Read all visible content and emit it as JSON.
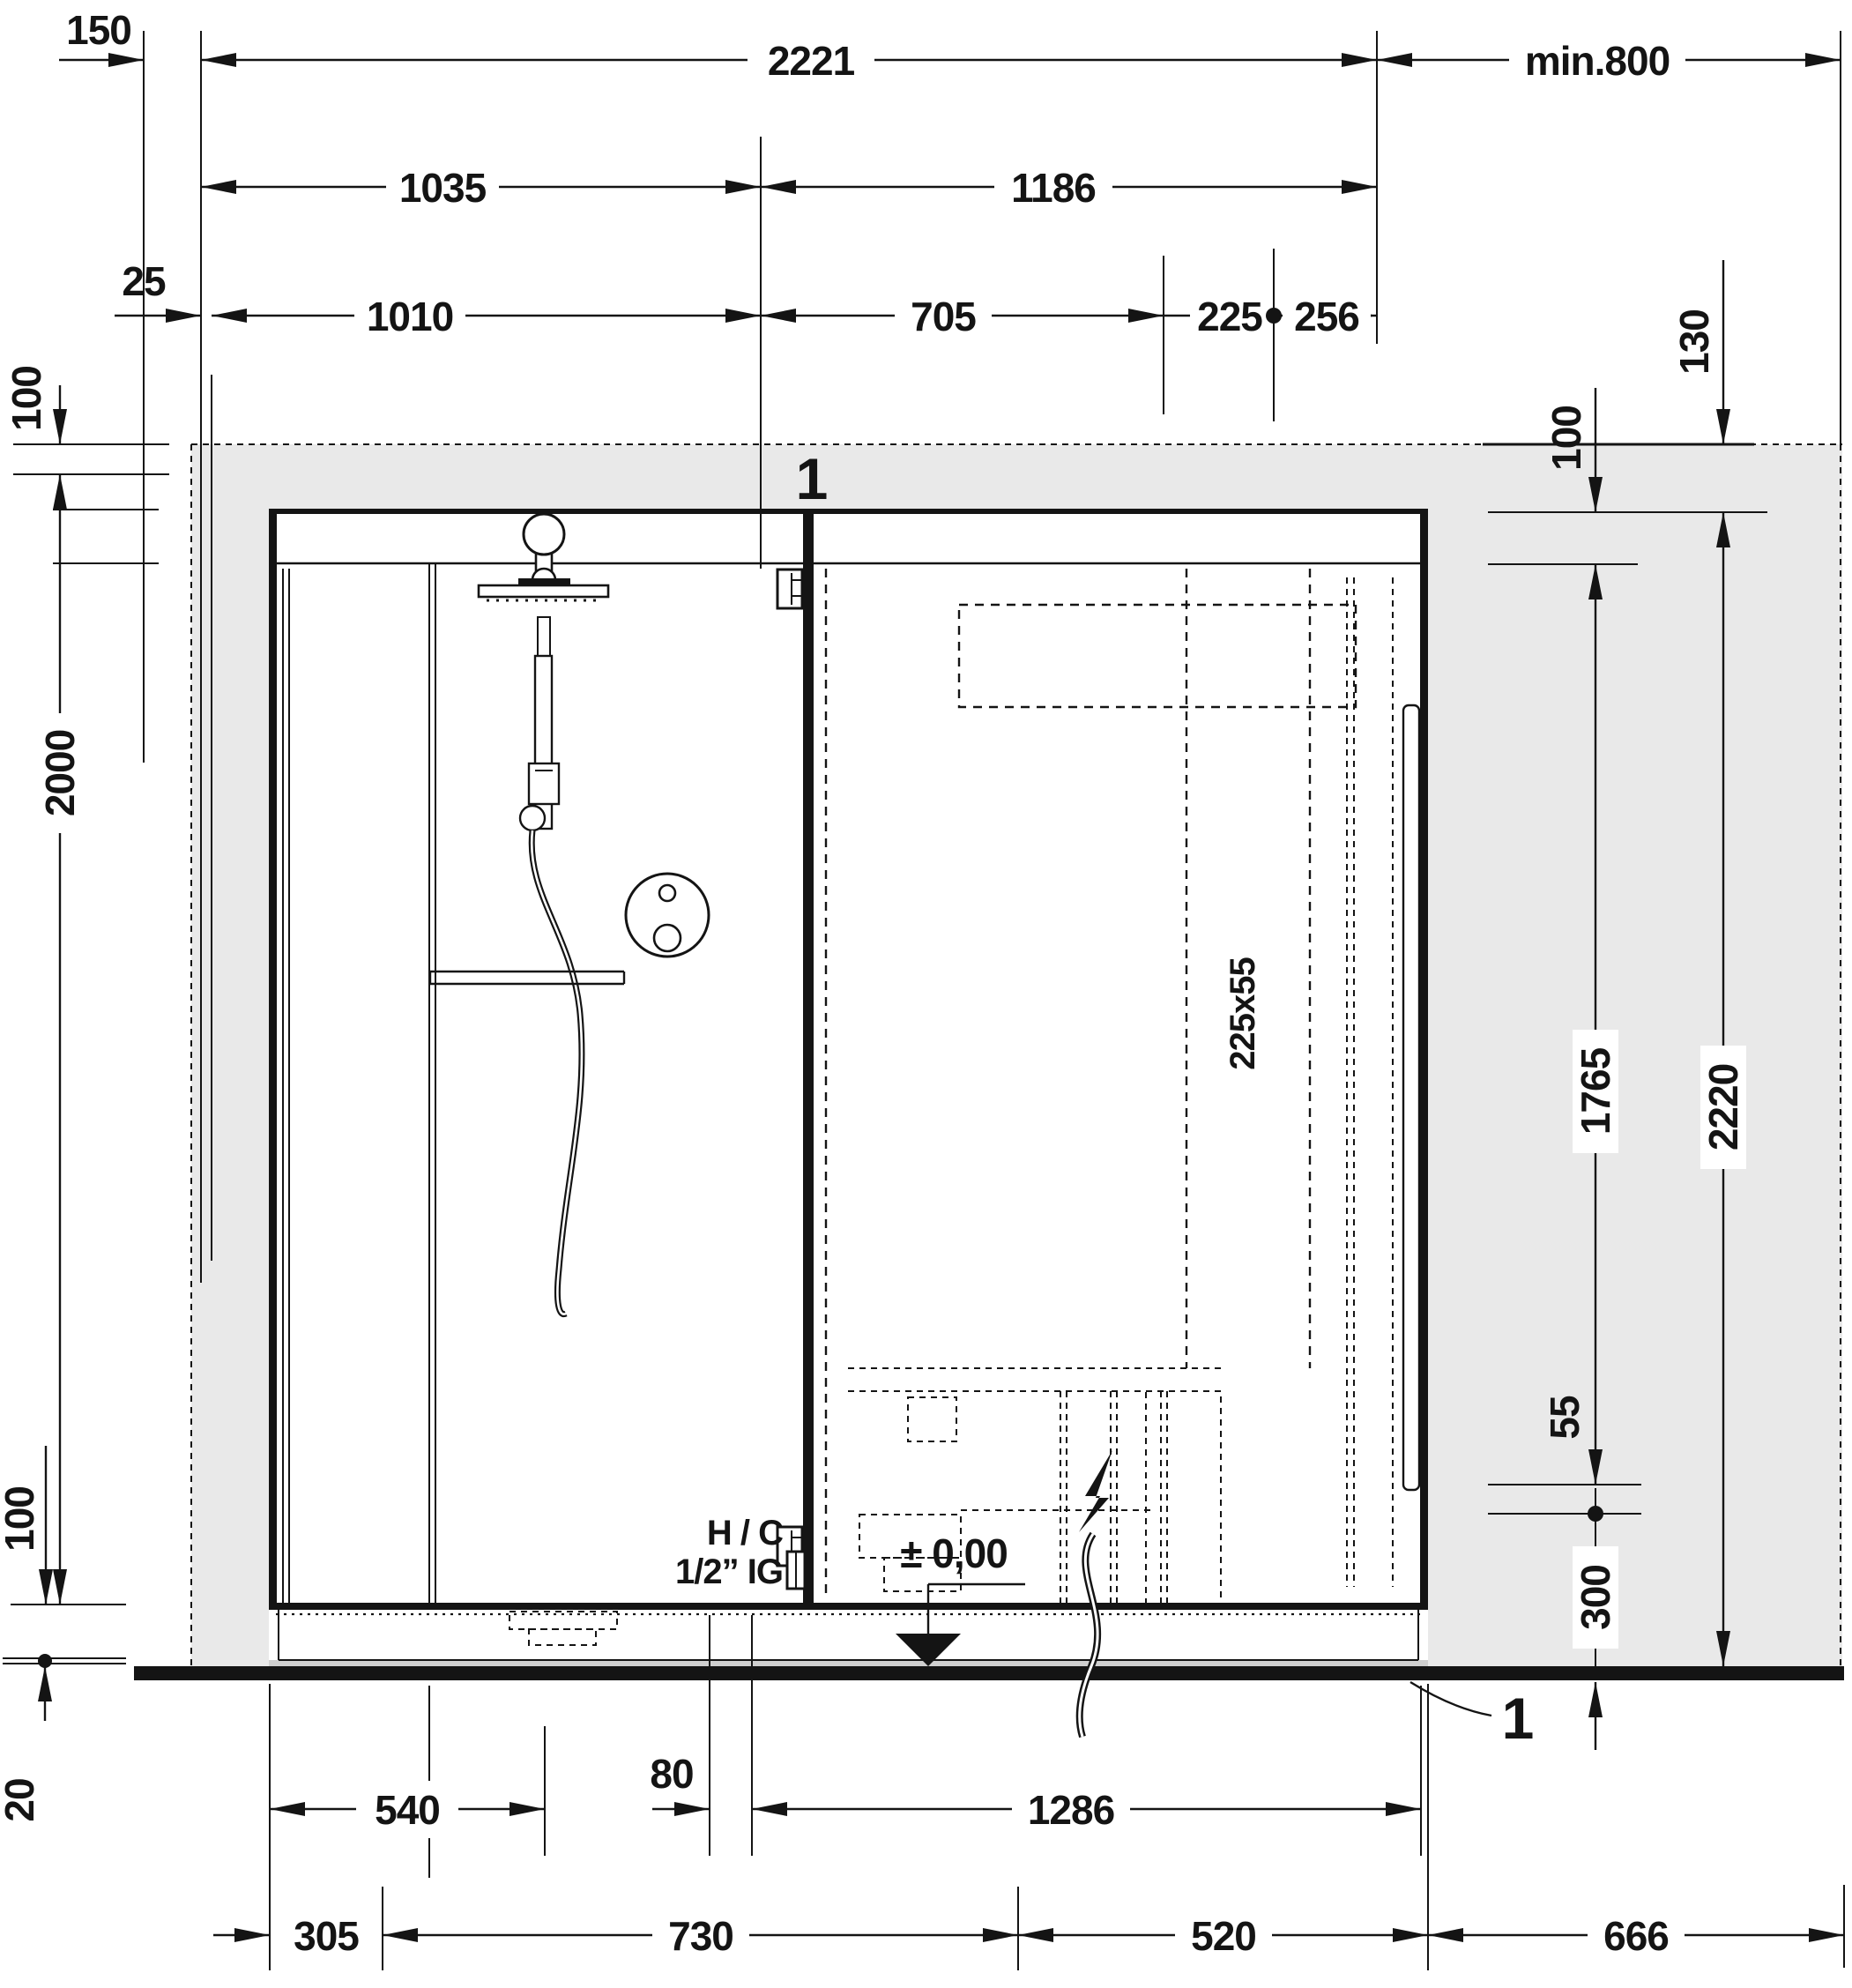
{
  "drawing": {
    "type": "installation-diagram",
    "subject": "shower and sauna cabin front elevation with installation dimensions",
    "units": "mm",
    "colors": {
      "line": "#141414",
      "wall_fill": "#e9e9e9",
      "background": "#ffffff",
      "floor": "#141414"
    }
  },
  "dims": {
    "wall_left_thickness": "150",
    "wall_gap": "25",
    "overall_width": "2221",
    "shower_width": "1035",
    "sauna_width": "1186",
    "connection_width_left": "1010",
    "connection_width_mid": "705",
    "duct_offset": "225",
    "duct_to_edge": "256",
    "clearance_right": "min.800",
    "offset_top_right": "130",
    "ceiling_gap_right": "100",
    "ceiling_gap_left": "100",
    "glass_height": "2000",
    "base_height_left": "100",
    "floor_gap": "20",
    "total_height": "2220",
    "supply_height": "1765",
    "supply_spacing": "55",
    "socket_height": "300",
    "drain_offset": "540",
    "connection_gap": "80",
    "sauna_base_width": "1286",
    "seg_left": "305",
    "seg_shower": "730",
    "seg_door": "520",
    "seg_right": "666"
  },
  "labels": {
    "duct_size": "225x55",
    "level_mark": "± 0,00",
    "water_line1": "H / C",
    "water_line2": "1/2” IG",
    "section_top": "1",
    "section_bottom": "1"
  }
}
